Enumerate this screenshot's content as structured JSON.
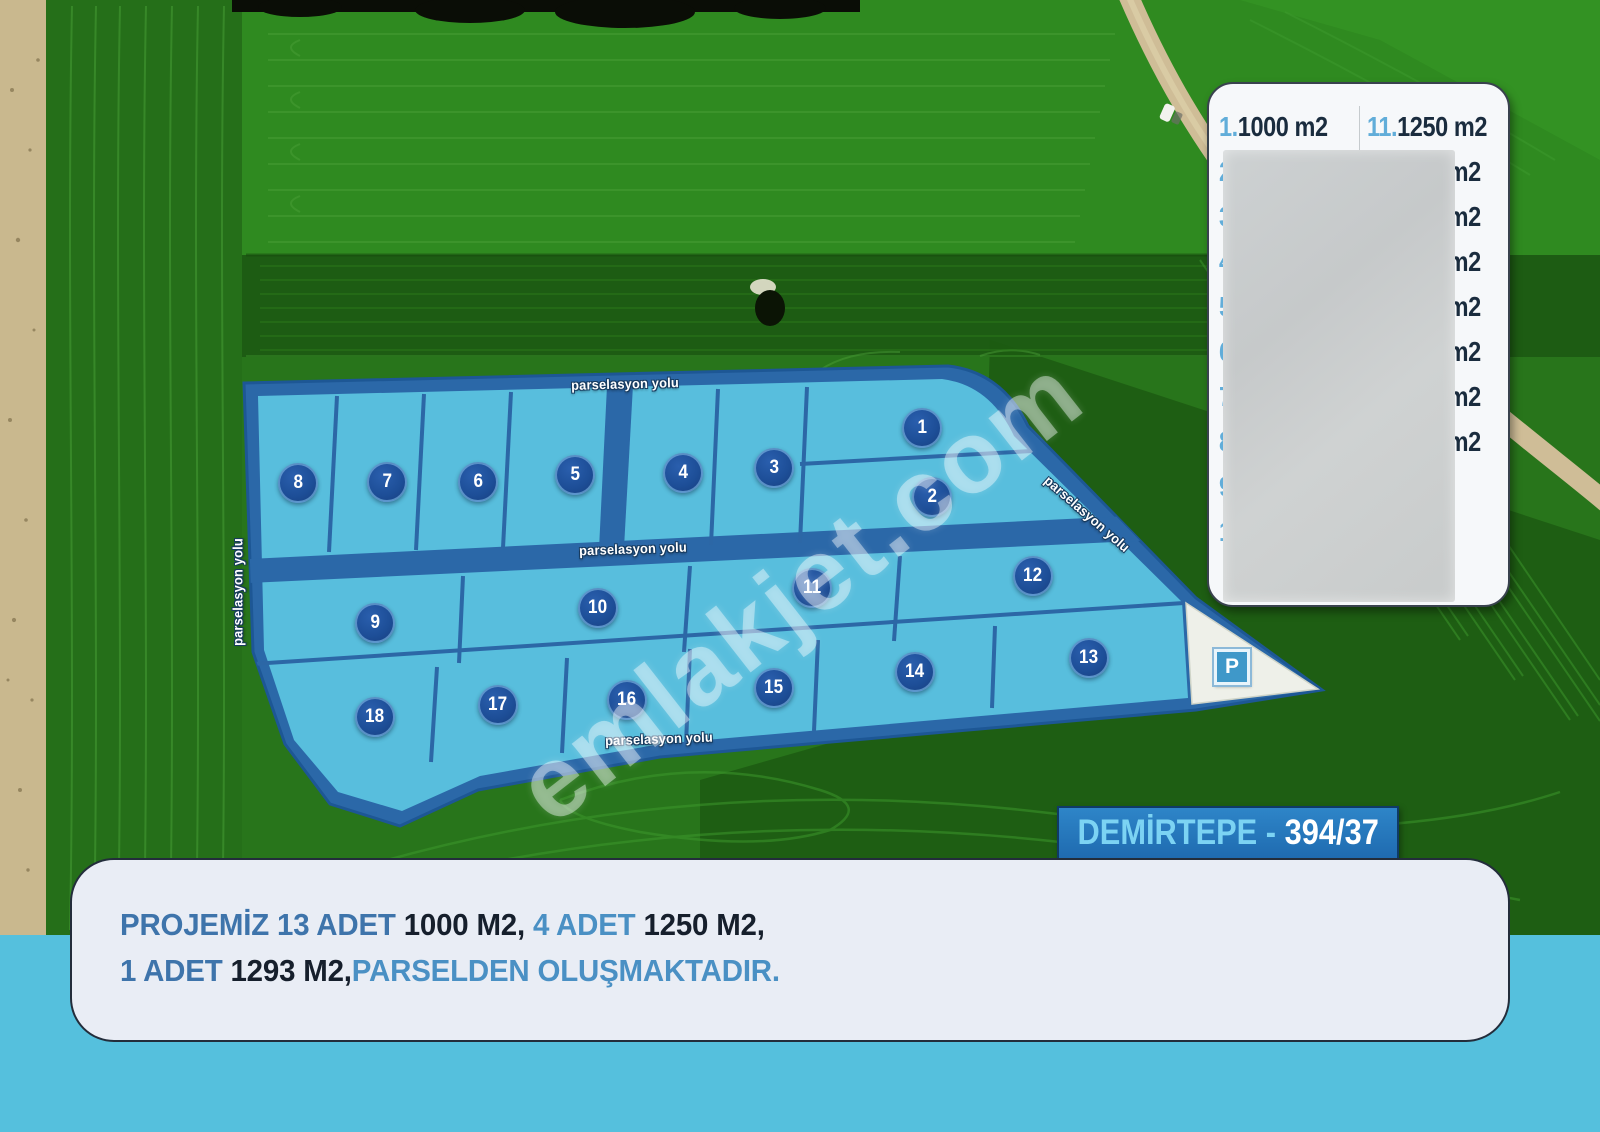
{
  "map": {
    "road_label": "parselasyon yolu",
    "parcels": [
      "1",
      "2",
      "3",
      "4",
      "5",
      "6",
      "7",
      "8",
      "9",
      "10",
      "11",
      "12",
      "13",
      "14",
      "15",
      "16",
      "17",
      "18"
    ],
    "parking_label": "P"
  },
  "legend": {
    "left": [
      {
        "num": "1.",
        "value": "1000 m2"
      },
      {
        "num": "2.",
        "value": ""
      },
      {
        "num": "3.",
        "value": ""
      },
      {
        "num": "4.",
        "value": ""
      },
      {
        "num": "5.",
        "value": ""
      },
      {
        "num": "6.",
        "value": ""
      },
      {
        "num": "7.",
        "value": ""
      },
      {
        "num": "8.",
        "value": ""
      },
      {
        "num": "9.",
        "value": ""
      },
      {
        "num": "10.",
        "value": ""
      }
    ],
    "right": [
      {
        "num": "11.",
        "value": "1250 m2"
      },
      {
        "num": "",
        "value": "m2"
      },
      {
        "num": "",
        "value": "m2"
      },
      {
        "num": "",
        "value": "m2"
      },
      {
        "num": "",
        "value": "m2"
      },
      {
        "num": "",
        "value": "m2"
      },
      {
        "num": "",
        "value": "m2"
      },
      {
        "num": "",
        "value": "m2"
      }
    ],
    "redacted": true
  },
  "banner": {
    "title": "DEMİRTEPE",
    "separator": " - ",
    "code": "394/37"
  },
  "info_card": {
    "line1": [
      {
        "text": "PROJEMİZ 13 ADET ",
        "tone": "mid"
      },
      {
        "text": "1000 M2, ",
        "tone": "dark"
      },
      {
        "text": "4 ADET ",
        "tone": "light"
      },
      {
        "text": "1250 M2,",
        "tone": "dark"
      }
    ],
    "line2": [
      {
        "text": "1 ADET ",
        "tone": "mid"
      },
      {
        "text": "1293 M2,",
        "tone": "dark"
      },
      {
        "text": "PARSELDEN OLUŞMAKTADIR.",
        "tone": "light"
      }
    ]
  },
  "watermark": "emlakjet.com",
  "colors": {
    "parcel_fill": "#58bedd",
    "road_blue": "#2b68a8",
    "badge_blue": "#1d4e97",
    "footer_band": "#55c0dd",
    "banner_blue": "#2478bb",
    "banner_cyan": "#7cd3f3",
    "legend_number_blue": "#61add9",
    "legend_text_dark": "#1a2c3e",
    "field_green": "#2f8a20",
    "dirt_tan": "#cfbd97"
  }
}
